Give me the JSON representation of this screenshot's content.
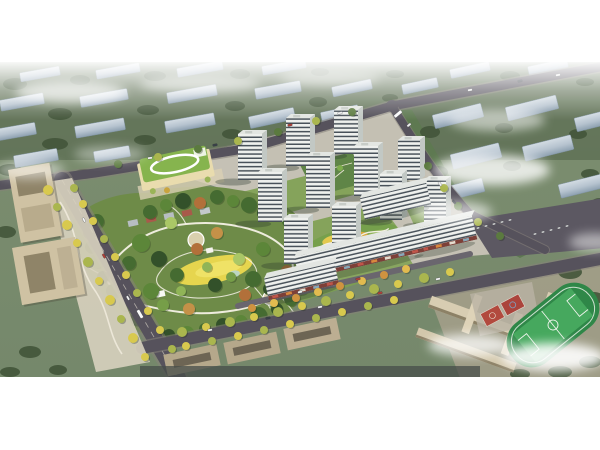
{
  "meta": {
    "alt": "Aerial architectural rendering of a residential master plan: white high-rise towers and mid-rise slabs around a large landscaped central park, a kindergarten with green roof, office buildings, a school campus with sports field, tree-lined boulevards, and faded context city blocks under light fog"
  },
  "palette": {
    "bg": "#ffffff",
    "ground": "#7c8d6f",
    "groundTop": "#5f7156",
    "road": "#56525c",
    "site": "#c9c4b8",
    "court": "#7da051",
    "parkBase": "#6e8b48",
    "meadow": "#e6d54e",
    "path": "#f4f1e6",
    "towerFront": "#eef0ed",
    "towerStripe": "#49525a",
    "towerSide": "#c2c8c4",
    "towerRoof": "#e3e6e2",
    "kgRoof": "#86b44e",
    "kgBody": "#e9dcae",
    "office": "#cfc2a3",
    "school": "#d8cdb2",
    "field": "#2f8748",
    "pitch": "#46a85e",
    "courtRed": "#b24a3e",
    "parking": "#5c5862",
    "cloud": "#ffffff",
    "ctxTree": "#42553a"
  },
  "tree_colors": {
    "street": [
      "#d8c94e",
      "#aab64e",
      "#6f9144",
      "#cf9340",
      "#e2bb4f",
      "#5b7a3f"
    ],
    "park": [
      "#33512a",
      "#456b31",
      "#5c8639",
      "#769e48",
      "#90b457",
      "#aac766",
      "#b2703a",
      "#c49148"
    ]
  },
  "car_colors": [
    "#f0f0f0",
    "#b04038",
    "#3a4148",
    "#fafafa",
    "#e8e8e8"
  ],
  "scene": {
    "context_blocks": [
      [
        40,
        12,
        40,
        9,
        -10
      ],
      [
        118,
        9,
        44,
        9,
        -10
      ],
      [
        200,
        7,
        46,
        9,
        -10
      ],
      [
        284,
        5,
        44,
        9,
        -10
      ],
      [
        470,
        8,
        40,
        9,
        -12
      ],
      [
        548,
        5,
        40,
        9,
        -12
      ],
      [
        420,
        24,
        36,
        10,
        -12
      ],
      [
        22,
        40,
        44,
        11,
        -10
      ],
      [
        104,
        36,
        48,
        11,
        -10
      ],
      [
        192,
        32,
        50,
        11,
        -10
      ],
      [
        278,
        28,
        46,
        11,
        -10
      ],
      [
        352,
        26,
        40,
        10,
        -12
      ],
      [
        14,
        70,
        44,
        12,
        -10
      ],
      [
        100,
        66,
        50,
        12,
        -10
      ],
      [
        190,
        61,
        50,
        12,
        -10
      ],
      [
        272,
        56,
        46,
        12,
        -12
      ],
      [
        340,
        52,
        38,
        11,
        -12
      ],
      [
        36,
        96,
        44,
        12,
        -10
      ],
      [
        112,
        92,
        36,
        11,
        -10
      ],
      [
        458,
        54,
        50,
        14,
        -14
      ],
      [
        532,
        46,
        52,
        14,
        -14
      ],
      [
        596,
        58,
        42,
        14,
        -14
      ],
      [
        476,
        94,
        50,
        15,
        -14
      ],
      [
        548,
        86,
        50,
        15,
        -14
      ],
      [
        462,
        128,
        44,
        14,
        -14
      ],
      [
        582,
        124,
        46,
        14,
        -14
      ],
      [
        600,
        148,
        40,
        13,
        -16
      ]
    ],
    "context_trees": [
      [
        15,
        22,
        12,
        6
      ],
      [
        80,
        18,
        10,
        5
      ],
      [
        155,
        14,
        11,
        5
      ],
      [
        240,
        12,
        10,
        5
      ],
      [
        320,
        10,
        9,
        4
      ],
      [
        395,
        12,
        9,
        4
      ],
      [
        510,
        14,
        10,
        5
      ],
      [
        585,
        20,
        9,
        4
      ],
      [
        60,
        52,
        12,
        6
      ],
      [
        148,
        48,
        11,
        5
      ],
      [
        235,
        44,
        10,
        5
      ],
      [
        318,
        40,
        9,
        5
      ],
      [
        390,
        36,
        8,
        4
      ],
      [
        55,
        82,
        13,
        6
      ],
      [
        145,
        78,
        11,
        5
      ],
      [
        232,
        72,
        10,
        5
      ],
      [
        310,
        68,
        9,
        5
      ],
      [
        10,
        108,
        12,
        6
      ],
      [
        84,
        112,
        10,
        5
      ],
      [
        28,
        140,
        11,
        6
      ],
      [
        6,
        170,
        10,
        6
      ],
      [
        430,
        70,
        10,
        6
      ],
      [
        504,
        66,
        9,
        5
      ],
      [
        578,
        72,
        9,
        5
      ],
      [
        438,
        110,
        10,
        6
      ],
      [
        512,
        104,
        9,
        5
      ],
      [
        590,
        112,
        9,
        5
      ],
      [
        446,
        146,
        9,
        5
      ],
      [
        600,
        140,
        8,
        4
      ],
      [
        570,
        210,
        12,
        7
      ],
      [
        594,
        236,
        10,
        6
      ],
      [
        568,
        238,
        9,
        5
      ],
      [
        560,
        310,
        12,
        6
      ],
      [
        590,
        300,
        11,
        6
      ],
      [
        520,
        312,
        10,
        5
      ],
      [
        30,
        290,
        11,
        6
      ],
      [
        10,
        310,
        10,
        5
      ],
      [
        58,
        308,
        9,
        5
      ]
    ],
    "towers": [
      [
        334,
        92,
        24,
        44
      ],
      [
        286,
        104,
        24,
        48
      ],
      [
        238,
        118,
        24,
        46
      ],
      [
        398,
        118,
        22,
        40
      ],
      [
        354,
        134,
        24,
        50
      ],
      [
        306,
        146,
        24,
        52
      ],
      [
        258,
        160,
        24,
        50
      ],
      [
        380,
        158,
        22,
        46
      ],
      [
        424,
        162,
        22,
        44
      ],
      [
        332,
        190,
        24,
        46
      ],
      [
        284,
        202,
        24,
        46
      ]
    ],
    "slabs": [
      [
        398,
        150,
        68,
        22,
        -13,
        0
      ],
      [
        448,
        184,
        60,
        24,
        -13,
        1
      ],
      [
        362,
        204,
        128,
        24,
        -13,
        1
      ],
      [
        304,
        230,
        72,
        22,
        -13,
        1
      ]
    ],
    "street_trees": [
      [
        48,
        128,
        5,
        0
      ],
      [
        57,
        145,
        4,
        1
      ],
      [
        67,
        163,
        5,
        0
      ],
      [
        77,
        181,
        4,
        0
      ],
      [
        88,
        200,
        5,
        1
      ],
      [
        99,
        219,
        4,
        0
      ],
      [
        110,
        238,
        5,
        0
      ],
      [
        121,
        257,
        4,
        1
      ],
      [
        133,
        276,
        5,
        0
      ],
      [
        145,
        295,
        4,
        0
      ],
      [
        74,
        126,
        4,
        1
      ],
      [
        83,
        142,
        4,
        0
      ],
      [
        93,
        159,
        4,
        0
      ],
      [
        104,
        177,
        4,
        1
      ],
      [
        115,
        195,
        4,
        0
      ],
      [
        126,
        213,
        4,
        0
      ],
      [
        137,
        231,
        4,
        1
      ],
      [
        148,
        249,
        4,
        0
      ],
      [
        160,
        268,
        4,
        0
      ],
      [
        172,
        287,
        4,
        1
      ],
      [
        118,
        102,
        4,
        5
      ],
      [
        158,
        95,
        4,
        1
      ],
      [
        198,
        87,
        4,
        5
      ],
      [
        238,
        79,
        4,
        1
      ],
      [
        278,
        70,
        4,
        5
      ],
      [
        316,
        59,
        4,
        1
      ],
      [
        352,
        50,
        4,
        5
      ],
      [
        182,
        270,
        5,
        1
      ],
      [
        206,
        265,
        4,
        0
      ],
      [
        230,
        260,
        5,
        1
      ],
      [
        254,
        255,
        4,
        0
      ],
      [
        278,
        250,
        5,
        1
      ],
      [
        302,
        244,
        4,
        0
      ],
      [
        326,
        239,
        5,
        1
      ],
      [
        350,
        233,
        4,
        0
      ],
      [
        374,
        227,
        5,
        1
      ],
      [
        398,
        222,
        4,
        0
      ],
      [
        424,
        216,
        5,
        1
      ],
      [
        450,
        210,
        4,
        0
      ],
      [
        186,
        284,
        4,
        0
      ],
      [
        212,
        279,
        4,
        1
      ],
      [
        238,
        274,
        4,
        0
      ],
      [
        264,
        268,
        4,
        1
      ],
      [
        290,
        262,
        4,
        0
      ],
      [
        316,
        256,
        4,
        1
      ],
      [
        342,
        250,
        4,
        0
      ],
      [
        368,
        244,
        4,
        1
      ],
      [
        394,
        238,
        4,
        0
      ],
      [
        252,
        246,
        4,
        3
      ],
      [
        274,
        241,
        4,
        4
      ],
      [
        296,
        236,
        4,
        3
      ],
      [
        318,
        230,
        4,
        4
      ],
      [
        340,
        224,
        4,
        3
      ],
      [
        362,
        219,
        4,
        4
      ],
      [
        384,
        213,
        4,
        3
      ],
      [
        406,
        207,
        4,
        4
      ],
      [
        428,
        104,
        4,
        5
      ],
      [
        444,
        126,
        4,
        1
      ],
      [
        458,
        144,
        4,
        5
      ],
      [
        478,
        160,
        4,
        1
      ],
      [
        500,
        174,
        4,
        5
      ]
    ],
    "park_trees": [
      [
        150,
        150,
        7,
        1
      ],
      [
        166,
        143,
        6,
        2
      ],
      [
        183,
        139,
        8,
        0
      ],
      [
        200,
        141,
        6,
        6
      ],
      [
        217,
        135,
        7,
        1
      ],
      [
        233,
        139,
        6,
        2
      ],
      [
        249,
        143,
        8,
        1
      ],
      [
        263,
        151,
        6,
        0
      ],
      [
        277,
        147,
        7,
        2
      ],
      [
        289,
        159,
        7,
        1
      ],
      [
        297,
        171,
        6,
        0
      ],
      [
        305,
        183,
        7,
        2
      ],
      [
        309,
        197,
        6,
        1
      ],
      [
        307,
        211,
        7,
        0
      ],
      [
        301,
        225,
        8,
        2
      ],
      [
        291,
        237,
        7,
        1
      ],
      [
        277,
        247,
        6,
        0
      ],
      [
        259,
        253,
        8,
        1
      ],
      [
        241,
        259,
        6,
        2
      ],
      [
        223,
        263,
        7,
        0
      ],
      [
        205,
        267,
        6,
        1
      ],
      [
        187,
        271,
        7,
        2
      ],
      [
        169,
        273,
        6,
        0
      ],
      [
        153,
        269,
        7,
        1
      ],
      [
        137,
        257,
        7,
        0
      ],
      [
        125,
        243,
        6,
        2
      ],
      [
        113,
        229,
        7,
        1
      ],
      [
        103,
        215,
        6,
        0
      ],
      [
        97,
        199,
        7,
        2
      ],
      [
        91,
        185,
        6,
        1
      ],
      [
        89,
        171,
        6,
        0
      ],
      [
        97,
        159,
        7,
        1
      ],
      [
        141,
        181,
        9,
        2
      ],
      [
        159,
        197,
        8,
        0
      ],
      [
        177,
        213,
        7,
        1
      ],
      [
        151,
        229,
        8,
        2
      ],
      [
        197,
        187,
        6,
        6
      ],
      [
        215,
        223,
        7,
        0
      ],
      [
        239,
        197,
        6,
        5
      ],
      [
        253,
        217,
        8,
        1
      ],
      [
        263,
        187,
        7,
        2
      ],
      [
        189,
        247,
        6,
        7
      ],
      [
        217,
        171,
        6,
        7
      ],
      [
        245,
        233,
        6,
        6
      ],
      [
        129,
        201,
        7,
        1
      ],
      [
        171,
        161,
        6,
        5
      ],
      [
        269,
        227,
        6,
        0
      ],
      [
        287,
        209,
        6,
        6
      ],
      [
        207,
        205,
        5,
        4
      ],
      [
        231,
        215,
        5,
        3
      ],
      [
        163,
        243,
        6,
        3
      ],
      [
        181,
        229,
        5,
        4
      ]
    ],
    "clouds": [
      [
        70,
        30,
        55,
        11,
        0.7
      ],
      [
        200,
        22,
        60,
        9,
        0.55
      ],
      [
        330,
        16,
        50,
        8,
        0.45
      ],
      [
        30,
        108,
        34,
        9,
        0.5
      ],
      [
        497,
        58,
        48,
        11,
        0.55
      ],
      [
        492,
        108,
        58,
        15,
        0.8
      ],
      [
        452,
        150,
        40,
        11,
        0.6
      ],
      [
        595,
        180,
        26,
        9,
        0.5
      ],
      [
        553,
        295,
        52,
        14,
        0.9
      ],
      [
        470,
        283,
        42,
        11,
        0.75
      ],
      [
        110,
        92,
        36,
        8,
        0.4
      ]
    ],
    "cars": [
      [
        150,
        96,
        -8,
        0
      ],
      [
        215,
        83,
        -10,
        2
      ],
      [
        290,
        63,
        -13,
        1
      ],
      [
        340,
        51,
        -14,
        0
      ],
      [
        398,
        52,
        -40,
        3
      ],
      [
        409,
        63,
        -40,
        0
      ],
      [
        470,
        28,
        -10,
        0
      ],
      [
        520,
        19,
        -10,
        2
      ],
      [
        558,
        13,
        -10,
        0
      ],
      [
        84,
        158,
        60,
        0
      ],
      [
        104,
        194,
        60,
        1
      ],
      [
        128,
        236,
        60,
        0
      ],
      [
        140,
        252,
        60,
        3
      ],
      [
        210,
        268,
        -11,
        0
      ],
      [
        268,
        256,
        -11,
        2
      ],
      [
        320,
        245,
        -12,
        0
      ],
      [
        380,
        231,
        -12,
        1
      ],
      [
        438,
        217,
        -13,
        0
      ],
      [
        440,
        122,
        55,
        0
      ],
      [
        454,
        140,
        50,
        2
      ],
      [
        300,
        230,
        -12,
        0
      ],
      [
        358,
        217,
        -12,
        1
      ],
      [
        478,
        166,
        -10,
        4
      ],
      [
        486,
        164,
        -10,
        4
      ],
      [
        494,
        162,
        -10,
        4
      ],
      [
        502,
        160,
        -10,
        4
      ],
      [
        510,
        158,
        -10,
        4
      ],
      [
        535,
        172,
        -10,
        4
      ],
      [
        543,
        170,
        -10,
        4
      ],
      [
        551,
        168,
        -10,
        4
      ],
      [
        559,
        166,
        -10,
        4
      ],
      [
        567,
        164,
        -10,
        4
      ]
    ]
  }
}
